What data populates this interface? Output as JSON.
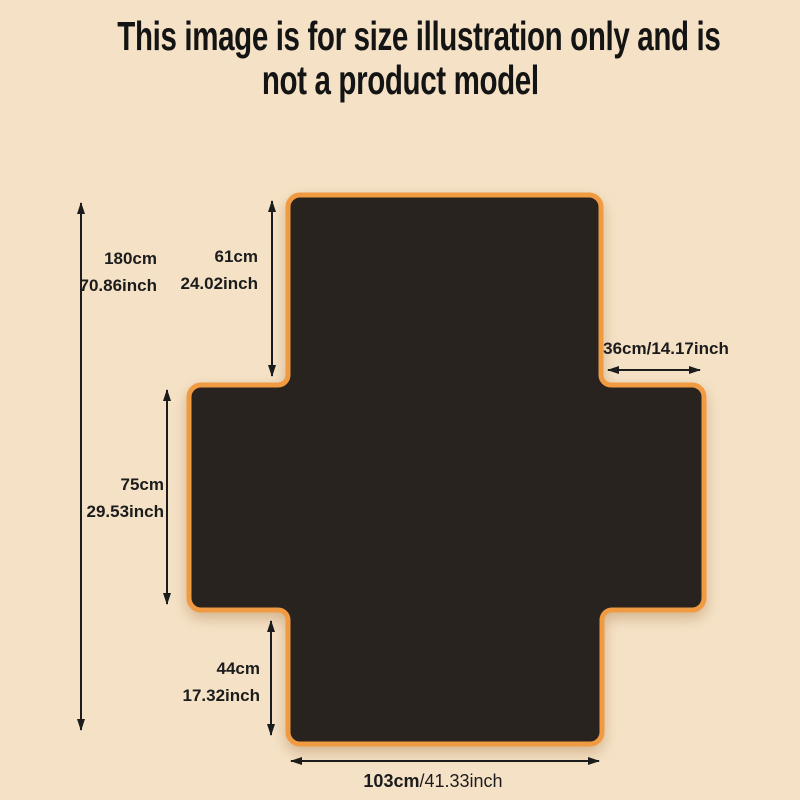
{
  "title": {
    "line1": "This image is for size illustration only and is",
    "line2": "not a product model"
  },
  "colors": {
    "background": "#f5e2c6",
    "cover_fill": "#29231f",
    "trim_orange": "#f09b42",
    "ink": "#1c1c1c"
  },
  "figure": {
    "name": "sofa-cover-size-diagram",
    "shape": "cross-layout-cover"
  },
  "labels": {
    "total": {
      "cm": "180cm",
      "inch": "70.86inch"
    },
    "back": {
      "cm": "61cm",
      "inch": "24.02inch"
    },
    "side": {
      "text": "36cm/14.17inch"
    },
    "seat": {
      "cm": "75cm",
      "inch": "29.53inch"
    },
    "front": {
      "cm": "44cm",
      "inch": "17.32inch"
    },
    "bottom": {
      "cm": "103cm",
      "inch": "/41.33inch"
    }
  }
}
